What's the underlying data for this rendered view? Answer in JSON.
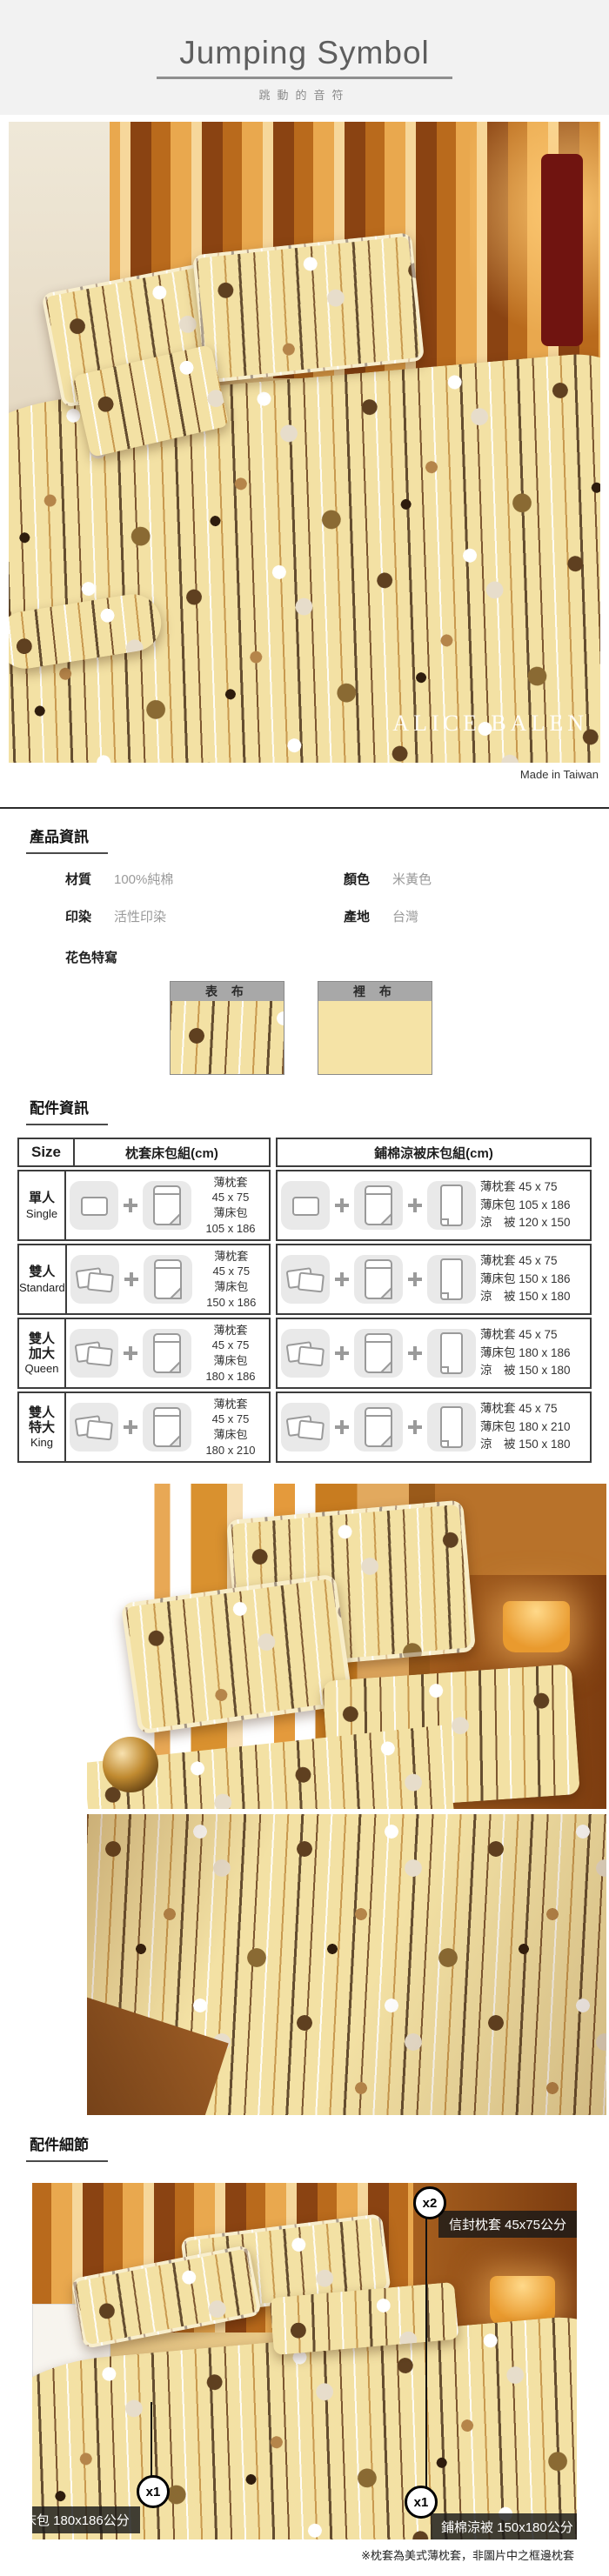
{
  "header": {
    "title": "Jumping Symbol",
    "subtitle": "跳動的音符"
  },
  "hero": {
    "brand_watermark": "ALICE BALEN",
    "made_in": "Made in Taiwan"
  },
  "product_info": {
    "heading": "產品資訊",
    "material_label": "材質",
    "material_value": "100%純棉",
    "color_label": "顏色",
    "color_value": "米黃色",
    "print_label": "印染",
    "print_value": "活性印染",
    "origin_label": "產地",
    "origin_value": "台灣",
    "pattern_heading": "花色特寫",
    "front_swatch_label": "表 布",
    "lining_swatch_label": "裡 布",
    "lining_color": "#f5e3a6"
  },
  "accessories": {
    "heading": "配件資訊",
    "table": {
      "size_header": "Size",
      "pillow_set_header": "枕套床包組(cm)",
      "quilt_set_header": "鋪棉涼被床包組(cm)",
      "rows": [
        {
          "size_zh": "單人",
          "size_en": "Single",
          "set1_lines": [
            "薄枕套",
            "45 x 75",
            "薄床包",
            "105 x 186"
          ],
          "set2_lines": [
            "薄枕套 45 x 75",
            "薄床包 105 x 186",
            "涼　被 120 x 150"
          ]
        },
        {
          "size_zh": "雙人",
          "size_en": "Standard",
          "set1_lines": [
            "薄枕套",
            "45 x 75",
            "薄床包",
            "150 x 186"
          ],
          "set2_lines": [
            "薄枕套 45 x 75",
            "薄床包 150 x 186",
            "涼　被 150 x 180"
          ]
        },
        {
          "size_zh": "雙人加大",
          "size_en": "Queen",
          "set1_lines": [
            "薄枕套",
            "45 x 75",
            "薄床包",
            "180 x 186"
          ],
          "set2_lines": [
            "薄枕套 45 x 75",
            "薄床包 180 x 186",
            "涼　被 150 x 180"
          ]
        },
        {
          "size_zh": "雙人特大",
          "size_en": "King",
          "set1_lines": [
            "薄枕套",
            "45 x 75",
            "薄床包",
            "180 x 210"
          ],
          "set2_lines": [
            "薄枕套 45 x 75",
            "薄床包 180 x 210",
            "涼　被 150 x 180"
          ]
        }
      ]
    }
  },
  "details": {
    "heading": "配件細節",
    "callout_pillow": {
      "badge": "x2",
      "label": "信封枕套 45x75公分"
    },
    "callout_sheet": {
      "badge": "x1",
      "label": "薄床包 180x186公分"
    },
    "callout_quilt": {
      "badge": "x1",
      "label": "鋪棉涼被 150x180公分"
    },
    "note": "※枕套為美式薄枕套，非圖片中之框邊枕套"
  }
}
